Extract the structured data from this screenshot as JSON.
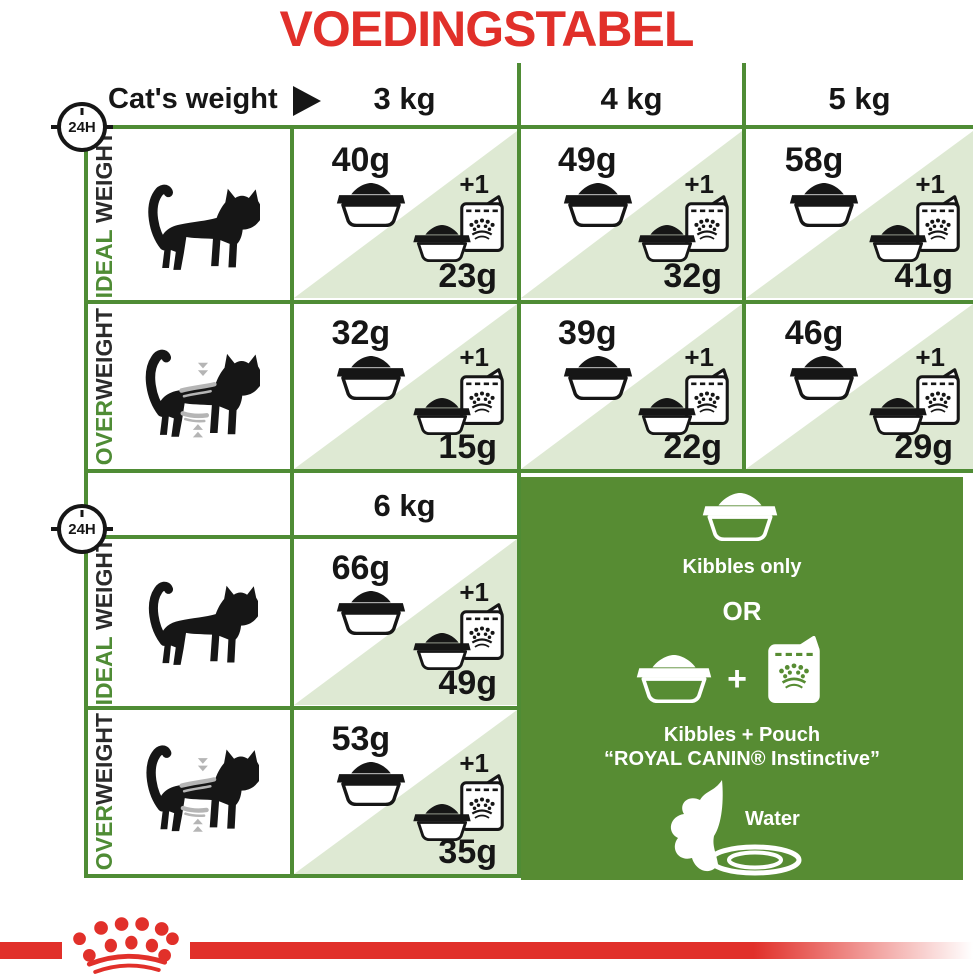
{
  "title": "VOEDINGSTABEL",
  "header": {
    "label": "Cat's weight",
    "badge": "24H"
  },
  "columns": {
    "c3": "3 kg",
    "c4": "4 kg",
    "c5": "5 kg",
    "c6": "6 kg"
  },
  "row_labels": {
    "ideal_green": "IDEAL",
    "ideal_dark": " WEIGHT",
    "over_green": "OVER",
    "over_dark": "WEIGHT"
  },
  "plus_one": "+1",
  "cells": {
    "ideal_3": {
      "kibbles": "40g",
      "with_pouch": "23g"
    },
    "ideal_4": {
      "kibbles": "49g",
      "with_pouch": "32g"
    },
    "ideal_5": {
      "kibbles": "58g",
      "with_pouch": "41g"
    },
    "over_3": {
      "kibbles": "32g",
      "with_pouch": "15g"
    },
    "over_4": {
      "kibbles": "39g",
      "with_pouch": "22g"
    },
    "over_5": {
      "kibbles": "46g",
      "with_pouch": "29g"
    },
    "ideal_6": {
      "kibbles": "66g",
      "with_pouch": "49g"
    },
    "over_6": {
      "kibbles": "53g",
      "with_pouch": "35g"
    }
  },
  "legend": {
    "kibbles_only": "Kibbles only",
    "or": "OR",
    "plus": "+",
    "kibbles_pouch": "Kibbles + Pouch",
    "pouch_name": "“ROYAL CANIN® Instinctive”",
    "water": "Water"
  },
  "colors": {
    "accent_red": "#e1302a",
    "border_green": "#4f8c35",
    "light_green": "#dee9d3",
    "panel_green": "#578c33"
  }
}
